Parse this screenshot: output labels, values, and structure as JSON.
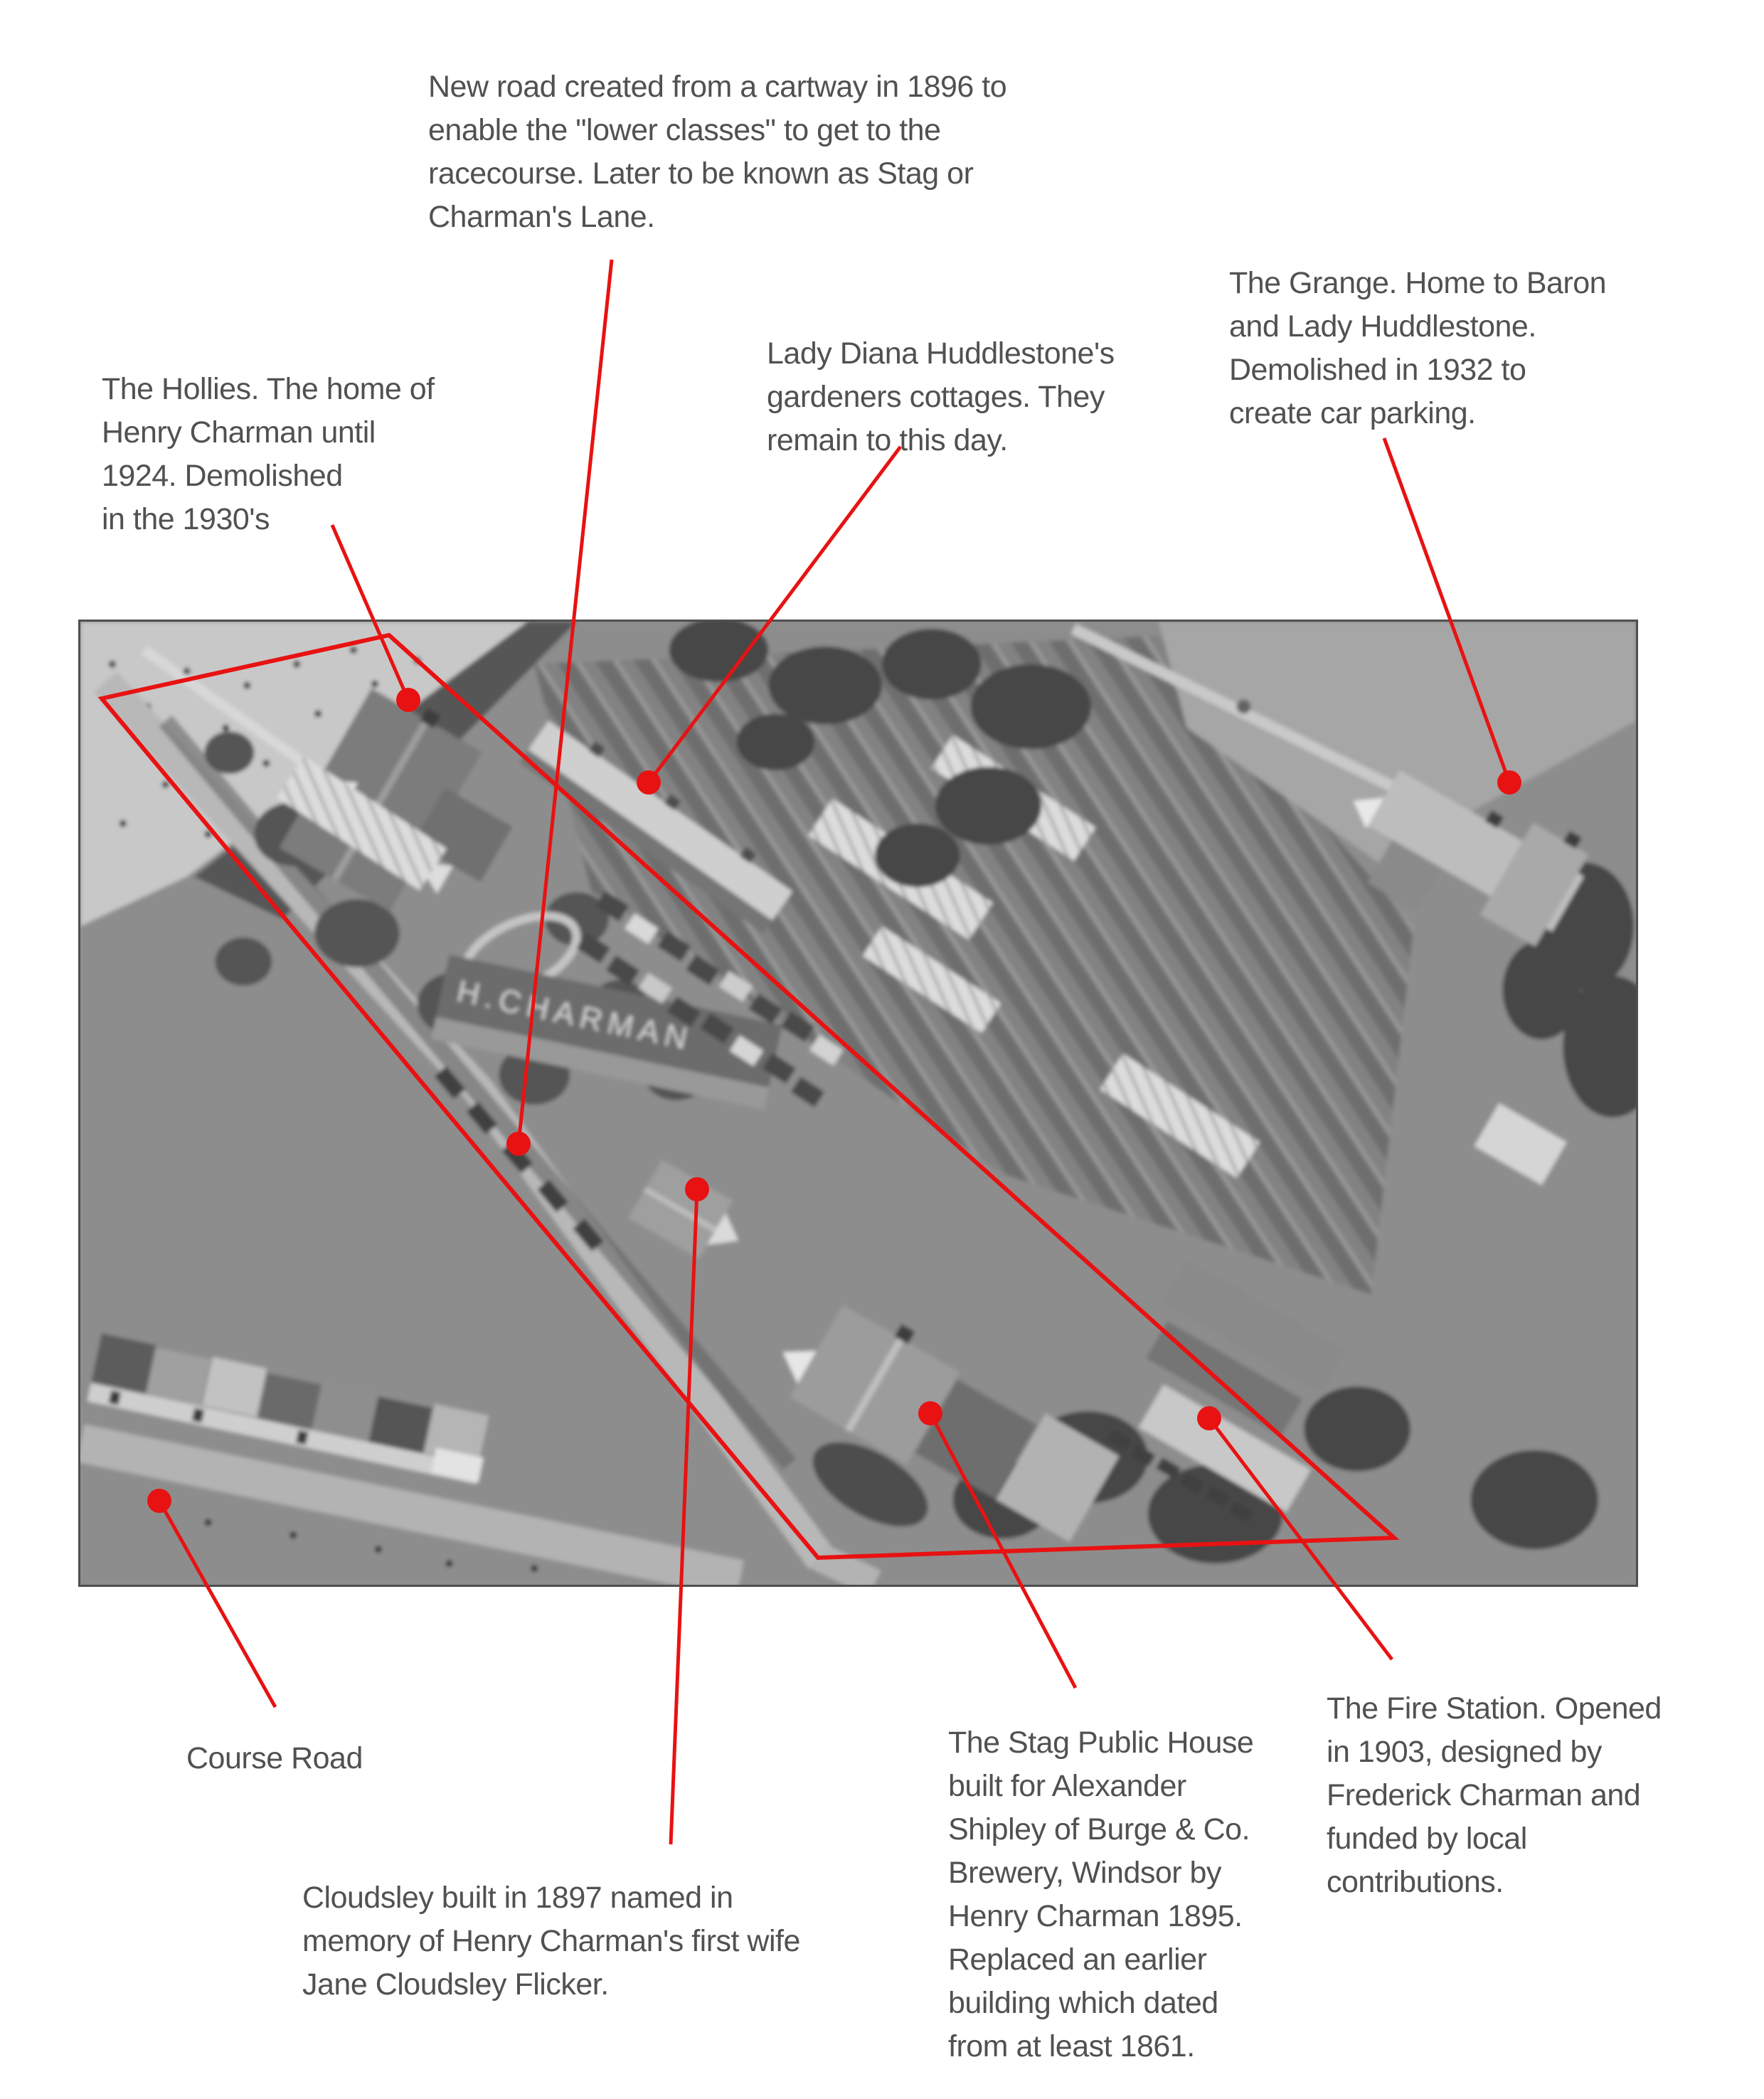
{
  "page": {
    "background": "#ffffff"
  },
  "colors": {
    "annotation_red": "#e81212",
    "label_gray": "#515151",
    "photo_border": "#4f4f4f"
  },
  "photo": {
    "alt": "Black and white oblique aerial photograph of a village street with houses, shops, nursery gardens and greenhouses",
    "roof_sign": "H.CHARMAN"
  },
  "annotations": {
    "new_road": {
      "label": "New road created from a cartway in 1896 to\nenable the \"lower classes\" to get to the\nracecourse. Later to be known as Stag or\nCharman's Lane."
    },
    "hollies": {
      "label": "The Hollies. The home of\nHenry Charman until\n1924. Demolished\nin the 1930's"
    },
    "gardeners_cottages": {
      "label": "Lady Diana Huddlestone's\ngardeners cottages. They\nremain to this day."
    },
    "grange": {
      "label": "The Grange. Home to Baron\nand Lady Huddlestone.\nDemolished in 1932 to\ncreate car parking."
    },
    "course_road": {
      "label": "Course Road"
    },
    "cloudsley": {
      "label": "Cloudsley built in 1897 named in\nmemory of Henry Charman's first wife\nJane Cloudsley Flicker."
    },
    "stag": {
      "label": "The Stag Public House\nbuilt for Alexander\nShipley of Burge & Co.\nBrewery, Windsor by\nHenry Charman 1895.\nReplaced an earlier\nbuilding which dated\nfrom at least 1861."
    },
    "fire_station": {
      "label": "The Fire Station. Opened\nin 1903, designed by\nFrederick Charman and\nfunded by local\ncontributions."
    }
  }
}
